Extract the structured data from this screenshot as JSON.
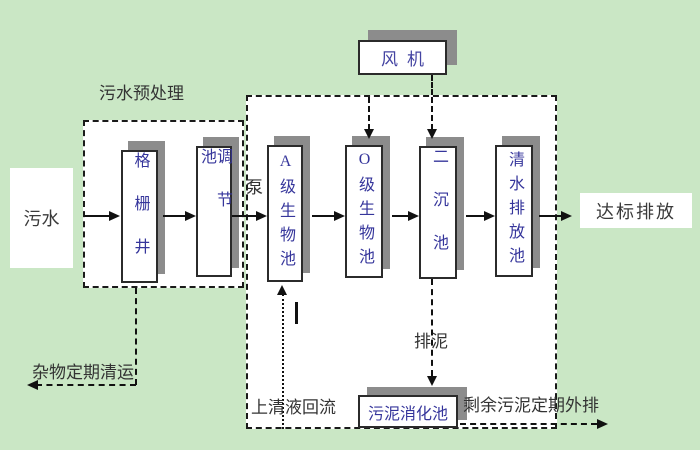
{
  "diagram": {
    "background_color": "#cae7c5",
    "colors": {
      "tank_text": "#35359b",
      "annotation_text": "#333333",
      "box_shadow": "#8c8c8c",
      "line": "#111111"
    },
    "endpoints": {
      "influent": {
        "label": "污水"
      },
      "effluent": {
        "label": "达标排放"
      }
    },
    "groups": {
      "pretreatment_label": "污水预处理"
    },
    "equipment": {
      "fan": {
        "label": "风机"
      },
      "digester": {
        "label": "污泥消化池"
      }
    },
    "tanks": [
      {
        "label": "格栅井"
      },
      {
        "label": "调节池"
      },
      {
        "label": "A级生物池"
      },
      {
        "label": "O级生物池"
      },
      {
        "label": "二沉池"
      },
      {
        "label": "清水排放池"
      }
    ],
    "annotations": {
      "pump": "泵",
      "sludge_discharge": "排泥",
      "debris_removal": "杂物定期清运",
      "supernatant_return": "上清液回流",
      "excess_sludge": "剩余污泥定期外排"
    }
  }
}
